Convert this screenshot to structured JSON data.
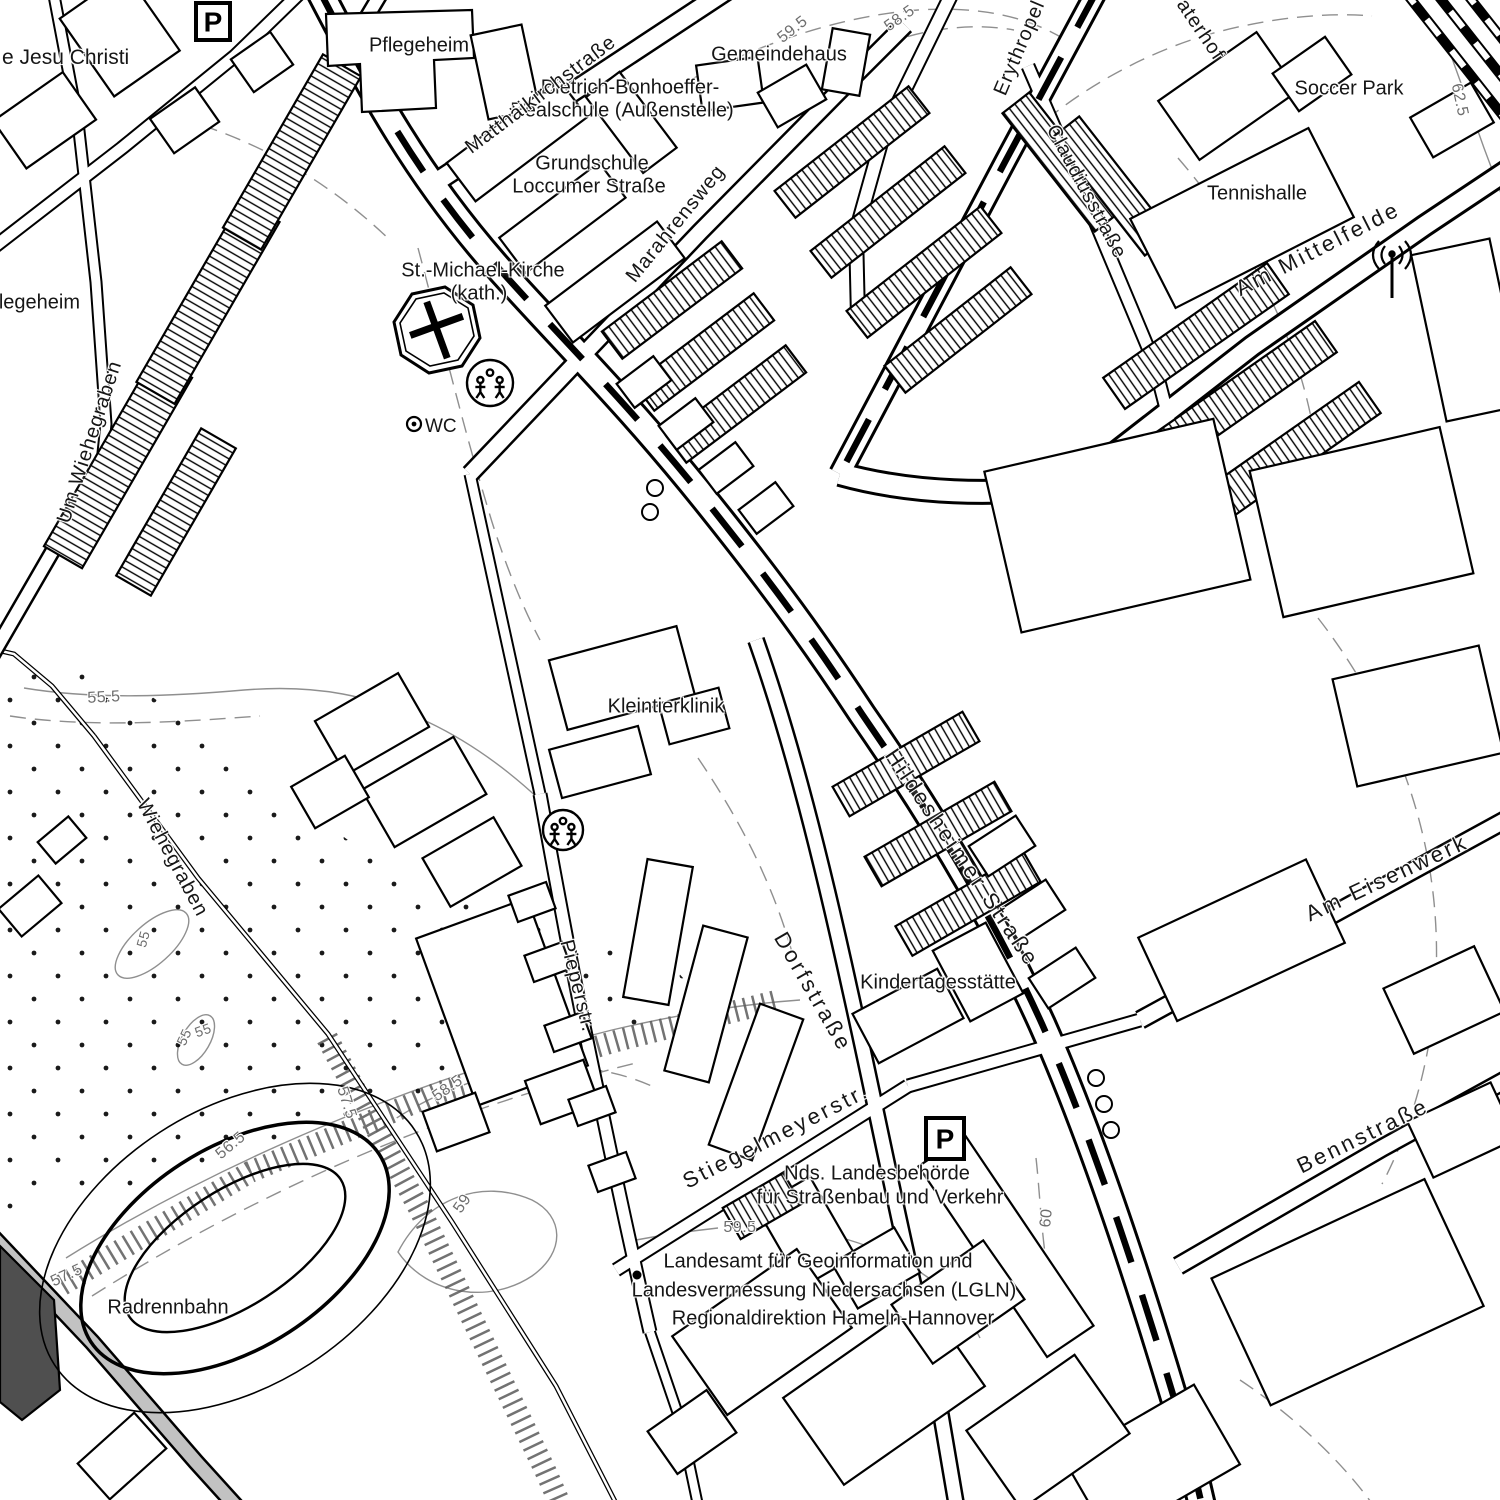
{
  "map": {
    "background_color": "#ffffff",
    "line_color": "#000000",
    "contour_color": "#8f8f8f",
    "place_labels": [
      {
        "id": "jesu-christi",
        "text": "e Jesu Christi",
        "x": 2,
        "y": 58,
        "rot": 0,
        "anchor": "start",
        "size": 21
      },
      {
        "id": "pflegeheim-top",
        "text": "Pflegeheim",
        "x": 419,
        "y": 46,
        "rot": 0
      },
      {
        "id": "dietrich-bonhoeffer-1",
        "text": "Dietrich-Bonhoeffer-",
        "x": 630,
        "y": 88,
        "rot": 0
      },
      {
        "id": "dietrich-bonhoeffer-2",
        "text": "Realschule (Außenstelle)",
        "x": 622,
        "y": 111,
        "rot": 0
      },
      {
        "id": "gemeindehaus",
        "text": "Gemeindehaus",
        "x": 779,
        "y": 55,
        "rot": 0
      },
      {
        "id": "grundschule-1",
        "text": "Grundschule",
        "x": 592,
        "y": 164,
        "rot": 0
      },
      {
        "id": "grundschule-2",
        "text": "Loccumer Straße",
        "x": 589,
        "y": 187,
        "rot": 0
      },
      {
        "id": "soccer-park",
        "text": "Soccer Park",
        "x": 1349,
        "y": 89,
        "rot": 0
      },
      {
        "id": "tennishalle",
        "text": "Tennishalle",
        "x": 1257,
        "y": 194,
        "rot": 0
      },
      {
        "id": "st-michael-1",
        "text": "St.-Michael-Kirche",
        "x": 483,
        "y": 271,
        "rot": 0
      },
      {
        "id": "st-michael-2",
        "text": "(kath.)",
        "x": 479,
        "y": 294,
        "rot": 0
      },
      {
        "id": "pflegeheim-left",
        "text": "Pflegeheim",
        "x": 30,
        "y": 303,
        "rot": 0
      },
      {
        "id": "wc",
        "text": "WC",
        "x": 425,
        "y": 427,
        "rot": 0,
        "anchor": "start",
        "size": 19
      },
      {
        "id": "kleintierklinik",
        "text": "Kleintierklinik",
        "x": 666,
        "y": 707,
        "rot": 0
      },
      {
        "id": "kindertagesstaette",
        "text": "Kindertagesstätte",
        "x": 938,
        "y": 983,
        "rot": 0
      },
      {
        "id": "nds-landesbehoerde-1",
        "text": "Nds. Landesbehörde",
        "x": 877,
        "y": 1174,
        "rot": 0
      },
      {
        "id": "nds-landesbehoerde-2",
        "text": "für Straßenbau und Verkehr",
        "x": 880,
        "y": 1198,
        "rot": 0
      },
      {
        "id": "lgln-1",
        "text": "Landesamt für Geoinformation und",
        "x": 818,
        "y": 1262,
        "rot": 0
      },
      {
        "id": "lgln-2",
        "text": "Landesvermessung Niedersachsen (LGLN)",
        "x": 824,
        "y": 1291,
        "rot": 0
      },
      {
        "id": "lgln-3",
        "text": "Regionaldirektion Hameln-Hannover",
        "x": 833,
        "y": 1319,
        "rot": 0
      },
      {
        "id": "radrennbahn",
        "text": "Radrennbahn",
        "x": 168,
        "y": 1308,
        "rot": 0
      }
    ],
    "street_labels": [
      {
        "id": "matthaeikirchstrasse",
        "text": "Matthäikirchstraße",
        "x": 541,
        "y": 95,
        "rot": -37
      },
      {
        "id": "marahrensweg",
        "text": "Marahrensweg",
        "x": 676,
        "y": 224,
        "rot": -51
      },
      {
        "id": "erythropel",
        "text": "Erythropel",
        "x": 1020,
        "y": 48,
        "rot": -67
      },
      {
        "id": "aterhof",
        "text": "aterhof",
        "x": 1200,
        "y": 30,
        "rot": 56
      },
      {
        "id": "claudiusstrasse",
        "text": "Claudiusstraße",
        "x": 1086,
        "y": 192,
        "rot": 62
      },
      {
        "id": "am-mittelfelde",
        "text": "Am Mittelfelde",
        "x": 1318,
        "y": 249,
        "rot": -27,
        "big": true
      },
      {
        "id": "hildesheimer-strasse",
        "text": "Hildesheimer Straße",
        "x": 962,
        "y": 858,
        "rot": 56,
        "big": true
      },
      {
        "id": "dorfstrasse",
        "text": "Dorfstraße",
        "x": 813,
        "y": 992,
        "rot": 60,
        "big": true
      },
      {
        "id": "pieperstr",
        "text": "Pieperstr.",
        "x": 577,
        "y": 986,
        "rot": 76
      },
      {
        "id": "stiegelmeyerstr",
        "text": "Stiegelmeyerstr.",
        "x": 776,
        "y": 1136,
        "rot": -27,
        "big": true
      },
      {
        "id": "wiehegraben",
        "text": "Wiehegraben",
        "x": 172,
        "y": 858,
        "rot": 62
      },
      {
        "id": "um-wiehegraben",
        "text": "Um Wiehegraben",
        "x": 90,
        "y": 442,
        "rot": -72
      },
      {
        "id": "am-eisenwerk",
        "text": "Am Eisenwerk",
        "x": 1387,
        "y": 878,
        "rot": -25,
        "big": true
      },
      {
        "id": "bennstrasse",
        "text": "Bennstraße",
        "x": 1363,
        "y": 1136,
        "rot": -26,
        "big": true
      }
    ],
    "contour_labels": [
      {
        "id": "c59-5-top",
        "text": "59.5",
        "x": 793,
        "y": 30,
        "rot": -38
      },
      {
        "id": "c58-5-top",
        "text": "58.5",
        "x": 900,
        "y": 19,
        "rot": -35
      },
      {
        "id": "c62-5",
        "text": "62.5",
        "x": 1459,
        "y": 100,
        "rot": 78
      },
      {
        "id": "c55-5",
        "text": "55.5",
        "x": 104,
        "y": 698,
        "rot": -3
      },
      {
        "id": "c55-a",
        "text": "55",
        "x": 143,
        "y": 939,
        "rot": -75,
        "small": true
      },
      {
        "id": "c55-b",
        "text": "55",
        "x": 184,
        "y": 1037,
        "rot": -65,
        "small": true
      },
      {
        "id": "c55-c",
        "text": "55",
        "x": 203,
        "y": 1030,
        "rot": -20,
        "small": true
      },
      {
        "id": "c56-5",
        "text": "56.5",
        "x": 231,
        "y": 1146,
        "rot": -40
      },
      {
        "id": "c57-5-a",
        "text": "57.5",
        "x": 346,
        "y": 1103,
        "rot": 72
      },
      {
        "id": "c57-5-b",
        "text": "57.5",
        "x": 67,
        "y": 1276,
        "rot": -25
      },
      {
        "id": "c58-5-b",
        "text": "58.5",
        "x": 448,
        "y": 1089,
        "rot": -35
      },
      {
        "id": "c59",
        "text": "59",
        "x": 463,
        "y": 1204,
        "rot": -55
      },
      {
        "id": "c59-5-b",
        "text": "59.5",
        "x": 740,
        "y": 1228,
        "rot": 0
      },
      {
        "id": "c60",
        "text": "60",
        "x": 1047,
        "y": 1218,
        "rot": -85
      }
    ],
    "symbols": {
      "parking": [
        {
          "id": "parking-top-left",
          "glyph": "P",
          "x": 196,
          "y": 3,
          "w": 34,
          "h": 37
        },
        {
          "id": "parking-stiegelmeyer",
          "glyph": "P",
          "x": 926,
          "y": 1118,
          "w": 38,
          "h": 41
        }
      ],
      "playground": [
        {
          "id": "playground-north",
          "x": 490,
          "y": 383,
          "r": 23
        },
        {
          "id": "playground-south",
          "x": 563,
          "y": 830,
          "r": 20
        }
      ],
      "church_cross": {
        "x": 437,
        "y": 330,
        "rot": -20
      },
      "wc_circle": {
        "x": 414,
        "y": 424
      },
      "antenna": {
        "x": 1392,
        "y": 268
      },
      "benchmark_dot": {
        "x": 637,
        "y": 1275
      },
      "circle_markers": [
        {
          "x": 655,
          "y": 488
        },
        {
          "x": 650,
          "y": 512
        },
        {
          "x": 1096,
          "y": 1078
        },
        {
          "x": 1104,
          "y": 1104
        },
        {
          "x": 1111,
          "y": 1130
        }
      ]
    }
  }
}
